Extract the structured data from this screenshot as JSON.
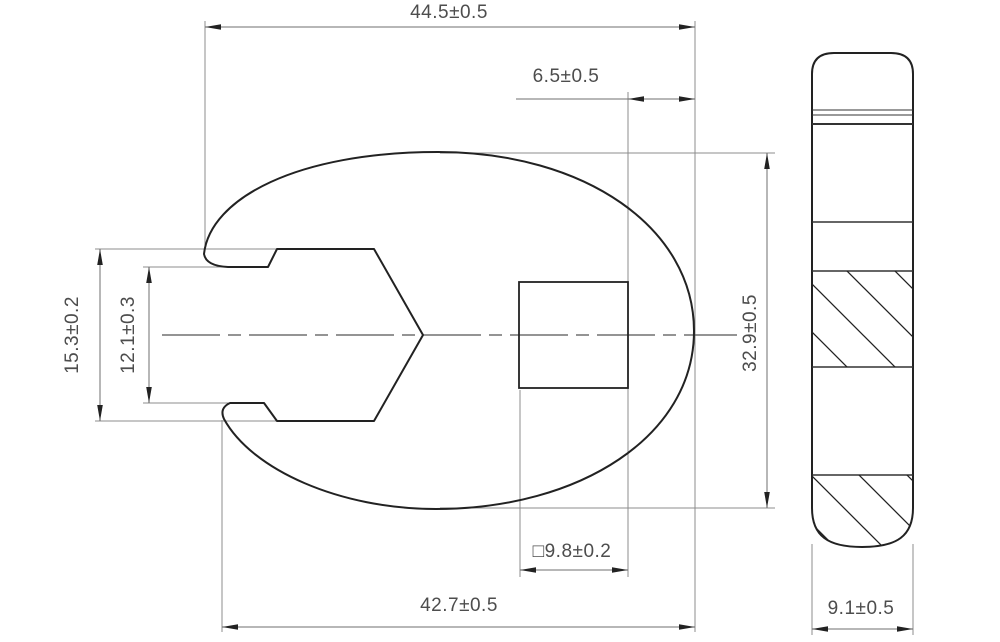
{
  "document": {
    "type": "technical-drawing",
    "subject": "Crowfoot wrench (crow's foot spanner), two-view dimensioned drawing",
    "views": {
      "front": "head with open jaw and square drive hole",
      "side": "profile with section hatching"
    },
    "dimensions": {
      "overall_width": {
        "label": "44.5±0.5",
        "value": 44.5,
        "tolerance": 0.5,
        "unit": "mm"
      },
      "drive_edge_offset": {
        "label": "6.5±0.5",
        "value": 6.5,
        "tolerance": 0.5,
        "unit": "mm"
      },
      "jaw_outer_width": {
        "label": "15.3±0.2",
        "value": 15.3,
        "tolerance": 0.2,
        "unit": "mm"
      },
      "jaw_opening": {
        "label": "12.1±0.3",
        "value": 12.1,
        "tolerance": 0.3,
        "unit": "mm"
      },
      "head_height": {
        "label": "32.9±0.5",
        "value": 32.9,
        "tolerance": 0.5,
        "unit": "mm"
      },
      "square_drive": {
        "label": "□9.8±0.2",
        "value": 9.8,
        "tolerance": 0.2,
        "unit": "mm"
      },
      "lower_width": {
        "label": "42.7±0.5",
        "value": 42.7,
        "tolerance": 0.5,
        "unit": "mm"
      },
      "thickness": {
        "label": "9.1±0.5",
        "value": 9.1,
        "tolerance": 0.5,
        "unit": "mm"
      }
    },
    "colors": {
      "background": "#ffffff",
      "contour": "#222222",
      "thin_line": "#8c8c8c",
      "dim_line": "#6f6f6f",
      "text": "#4d4d4d"
    }
  }
}
